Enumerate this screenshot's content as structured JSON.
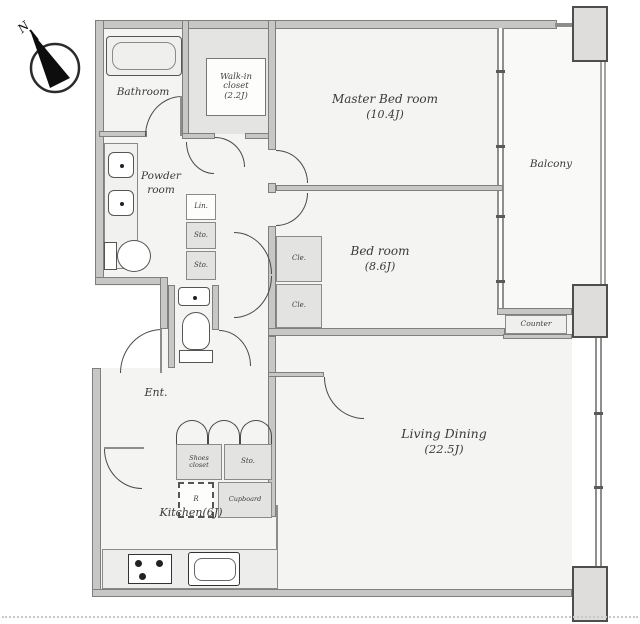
{
  "compass": {
    "label": "N"
  },
  "rooms": {
    "bathroom": {
      "label": "Bathroom"
    },
    "walk_in_closet": {
      "line1": "Walk-in",
      "line2": "closet",
      "line3": "(2.2J)"
    },
    "master_bedroom": {
      "line1": "Master Bed room",
      "line2": "(10.4J)"
    },
    "bedroom": {
      "line1": "Bed room",
      "line2": "(8.6J)"
    },
    "living_dining": {
      "line1": "Living Dining",
      "line2": "(22.5J)"
    },
    "kitchen": {
      "label": "Kitchen(6J)"
    },
    "powder_room": {
      "line1": "Powder",
      "line2": "room"
    },
    "balcony": {
      "label": "Balcony"
    },
    "entrance": {
      "label": "Ent."
    }
  },
  "storage": {
    "linen": {
      "label": "Lin."
    },
    "storage_upper": {
      "label": "Sto."
    },
    "storage_lower": {
      "label": "Sto."
    },
    "closet_upper": {
      "label": "Cle."
    },
    "closet_lower": {
      "label": "Cle."
    },
    "shoes_closet": {
      "line1": "Shoes",
      "line2": "closet"
    },
    "storage_hall": {
      "label": "Sto."
    },
    "refrigerator": {
      "label": "R"
    },
    "cupboard": {
      "label": "Cupboard"
    },
    "counter": {
      "label": "Counter"
    }
  },
  "colors": {
    "wall": "#8d8d8c",
    "storage_fill": "#e3e3e1",
    "column_fill": "#dedddc",
    "room_fill": "#f4f4f2"
  }
}
